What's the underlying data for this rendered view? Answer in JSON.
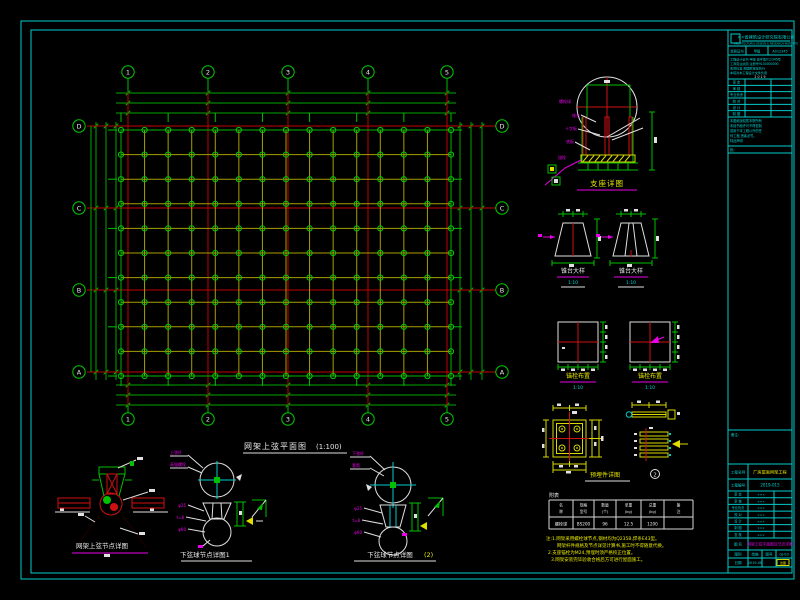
{
  "colors": {
    "background": "#000000",
    "frame_cyan": "#00cccc",
    "grid_green": "#00c000",
    "mesh_yellow": "#a8a000",
    "axis_red": "#c00000",
    "detail_yellow": "#d8d800",
    "magenta": "#e800e8",
    "white": "#e8e8e8"
  },
  "plan": {
    "title": "网架上弦平面图",
    "scale": "(1:100)",
    "col_axes": [
      "1",
      "2",
      "3",
      "4",
      "5"
    ],
    "row_axes": [
      "D",
      "C",
      "B",
      "A"
    ]
  },
  "details": {
    "d1": {
      "title": "支座详图",
      "labels": [
        "螺栓球",
        "锥台",
        "十字板",
        "底板",
        "锚栓"
      ]
    },
    "d2a": {
      "title": "锥台大样",
      "sub": "1:10"
    },
    "d2b": {
      "title": "锥台大样",
      "sub": "1:10"
    },
    "d3a": {
      "title": "锚栓布置",
      "sub": "1:10"
    },
    "d3b": {
      "title": "锚栓布置",
      "sub": "1:10"
    },
    "d4": {
      "title": "预埋件详图",
      "badge": "2"
    },
    "d6": {
      "title": "网架上弦节点详图"
    },
    "d7a": {
      "title": "下弦球节点详图1",
      "labels": [
        "上弦杆",
        "高强螺栓"
      ],
      "dims": [
        "φ25",
        "t=8",
        "φ60"
      ]
    },
    "d7b": {
      "title": "下弦球节点详图",
      "suffix": "(2)",
      "labels": [
        "下弦杆",
        "套筒"
      ],
      "dims": [
        "φ25",
        "t=8",
        "φ60"
      ]
    }
  },
  "table": {
    "label": "附表",
    "headers_l1": [
      "名",
      "规格",
      "数量",
      "单重",
      "总重",
      "备"
    ],
    "headers_l2": [
      "称",
      "型号",
      "(个)",
      "(kg)",
      "(kg)",
      "注"
    ],
    "values": [
      "螺栓球",
      "BS200",
      "96",
      "12.5",
      "1200",
      ""
    ]
  },
  "notes": [
    "注:1.网架采用螺栓球节点,钢材均为Q235B,焊条E43型。",
    "网架杆件规格及节点详见计算书,施工时不得随意代换。",
    "2.支座锚栓为M24,预埋时须严格校正位置。",
    "3.网架安装完毕验收合格后方可进行屋面施工。"
  ],
  "titleblock": {
    "company": "××省建筑设计研究院有限公司",
    "company_en": "ARCHITECTURAL DESIGN & RESEARCH INSTITUTE",
    "cert_row": [
      "资质证书",
      "甲级",
      "A012345"
    ],
    "cert_lines": [
      "工程设计证书 甲级 建字第012345号",
      "工商营业执照 注册号9100000000",
      "收费标准 按国家规定执行",
      "本院对本工程设计文件负责"
    ],
    "cert_extra": "2 0 1 9",
    "approve_rows": [
      "审 定",
      "审 核",
      "专业负责",
      "校 对",
      "设 计",
      "制 图"
    ],
    "statement": [
      "本图纸版权属本院所有",
      "未经书面许可不得复制",
      "或用于本工程以外的任",
      "何工程,违者必究。",
      "特此声明"
    ],
    "note_label": "批:",
    "remark_label": "备注:",
    "project_label": "工程名称",
    "project_value": "厂房屋面网架工程",
    "no_label": "工程编号",
    "no_value": "2019-015",
    "sign_rows": [
      "审 定",
      "审 核",
      "专业负责",
      "校 对",
      "设 计",
      "制 图",
      "复 核"
    ],
    "title_label": "图 名",
    "drawing_title": "网架上弦平面图及节点详图",
    "class_label": "图别",
    "class_value": "结施",
    "sheet_label": "图号",
    "sheet_value": "GJ-03",
    "date_label": "日期",
    "date_value": "2019.06",
    "stamp": "出图"
  }
}
